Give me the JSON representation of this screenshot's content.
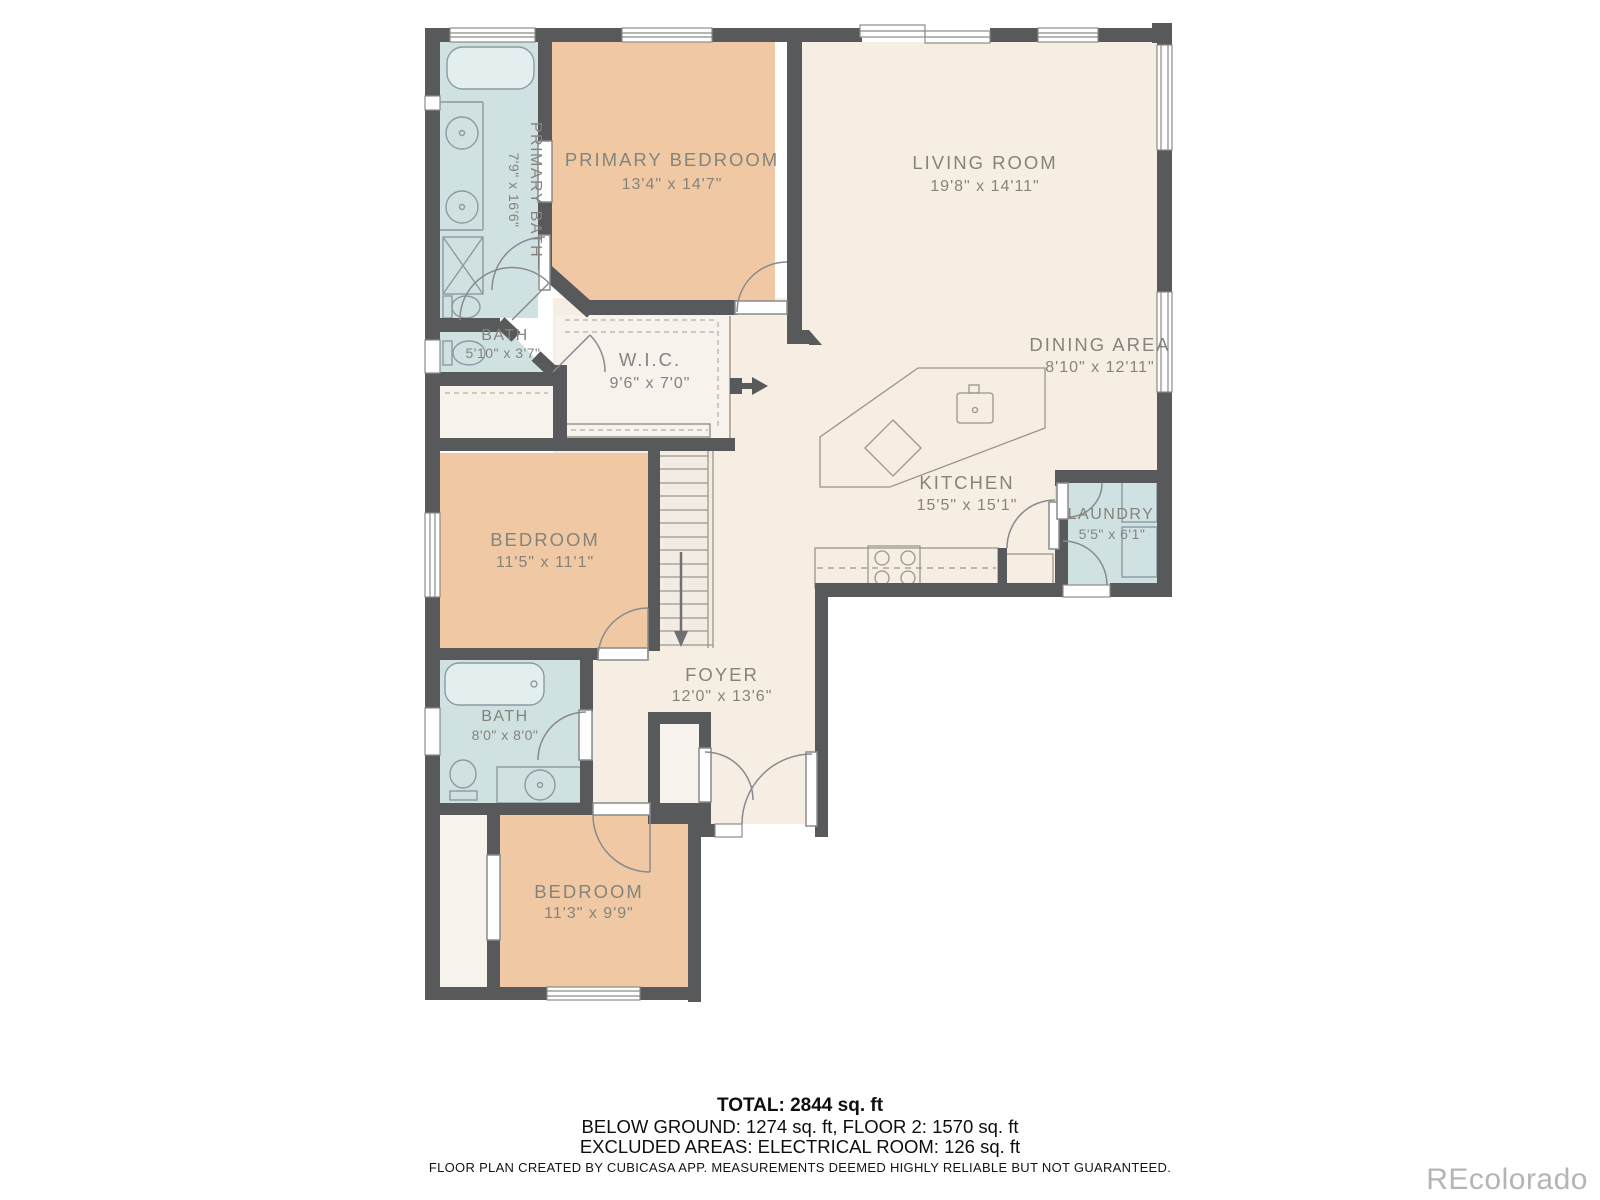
{
  "plan": {
    "rooms": {
      "primary_bath": {
        "name": "PRIMARY BATH",
        "dims": "7'9\" x 16'6\""
      },
      "primary_bedroom": {
        "name": "PRIMARY BEDROOM",
        "dims": "13'4\" x 14'7\""
      },
      "living_room": {
        "name": "LIVING ROOM",
        "dims": "19'8\" x 14'11\""
      },
      "bath_upper": {
        "name": "BATH",
        "dims": "5'10\" x 3'7\""
      },
      "wic": {
        "name": "W.I.C.",
        "dims": "9'6\" x 7'0\""
      },
      "dining_area": {
        "name": "DINING AREA",
        "dims": "8'10\" x 12'11\""
      },
      "kitchen": {
        "name": "KITCHEN",
        "dims": "15'5\" x 15'1\""
      },
      "laundry": {
        "name": "LAUNDRY",
        "dims": "5'5\" x 6'1\""
      },
      "bedroom_mid": {
        "name": "BEDROOM",
        "dims": "11'5\" x 11'1\""
      },
      "bath_lower": {
        "name": "BATH",
        "dims": "8'0\" x 8'0\""
      },
      "foyer": {
        "name": "FOYER",
        "dims": "12'0\" x 13'6\""
      },
      "bedroom_lower": {
        "name": "BEDROOM",
        "dims": "11'3\" x 9'9\""
      }
    },
    "summary": {
      "total": "TOTAL: 2844 sq. ft",
      "floors": "BELOW GROUND: 1274 sq. ft, FLOOR 2: 1570 sq. ft",
      "excluded": "EXCLUDED AREAS: ELECTRICAL ROOM: 126 sq. ft"
    },
    "disclaimer": "FLOOR PLAN CREATED BY CUBICASA APP. MEASUREMENTS DEEMED HIGHLY RELIABLE BUT NOT GUARANTEED.",
    "watermark": "REcolorado",
    "colors": {
      "wall": "#58595b",
      "bedroom_fill": "#f0c9a4",
      "bath_fill": "#cfe1e1",
      "living_fill": "#f7eee3",
      "closet_fill": "#f7f2eb",
      "fixture_line": "#8d9aa2",
      "label_text": "#84847c"
    }
  }
}
